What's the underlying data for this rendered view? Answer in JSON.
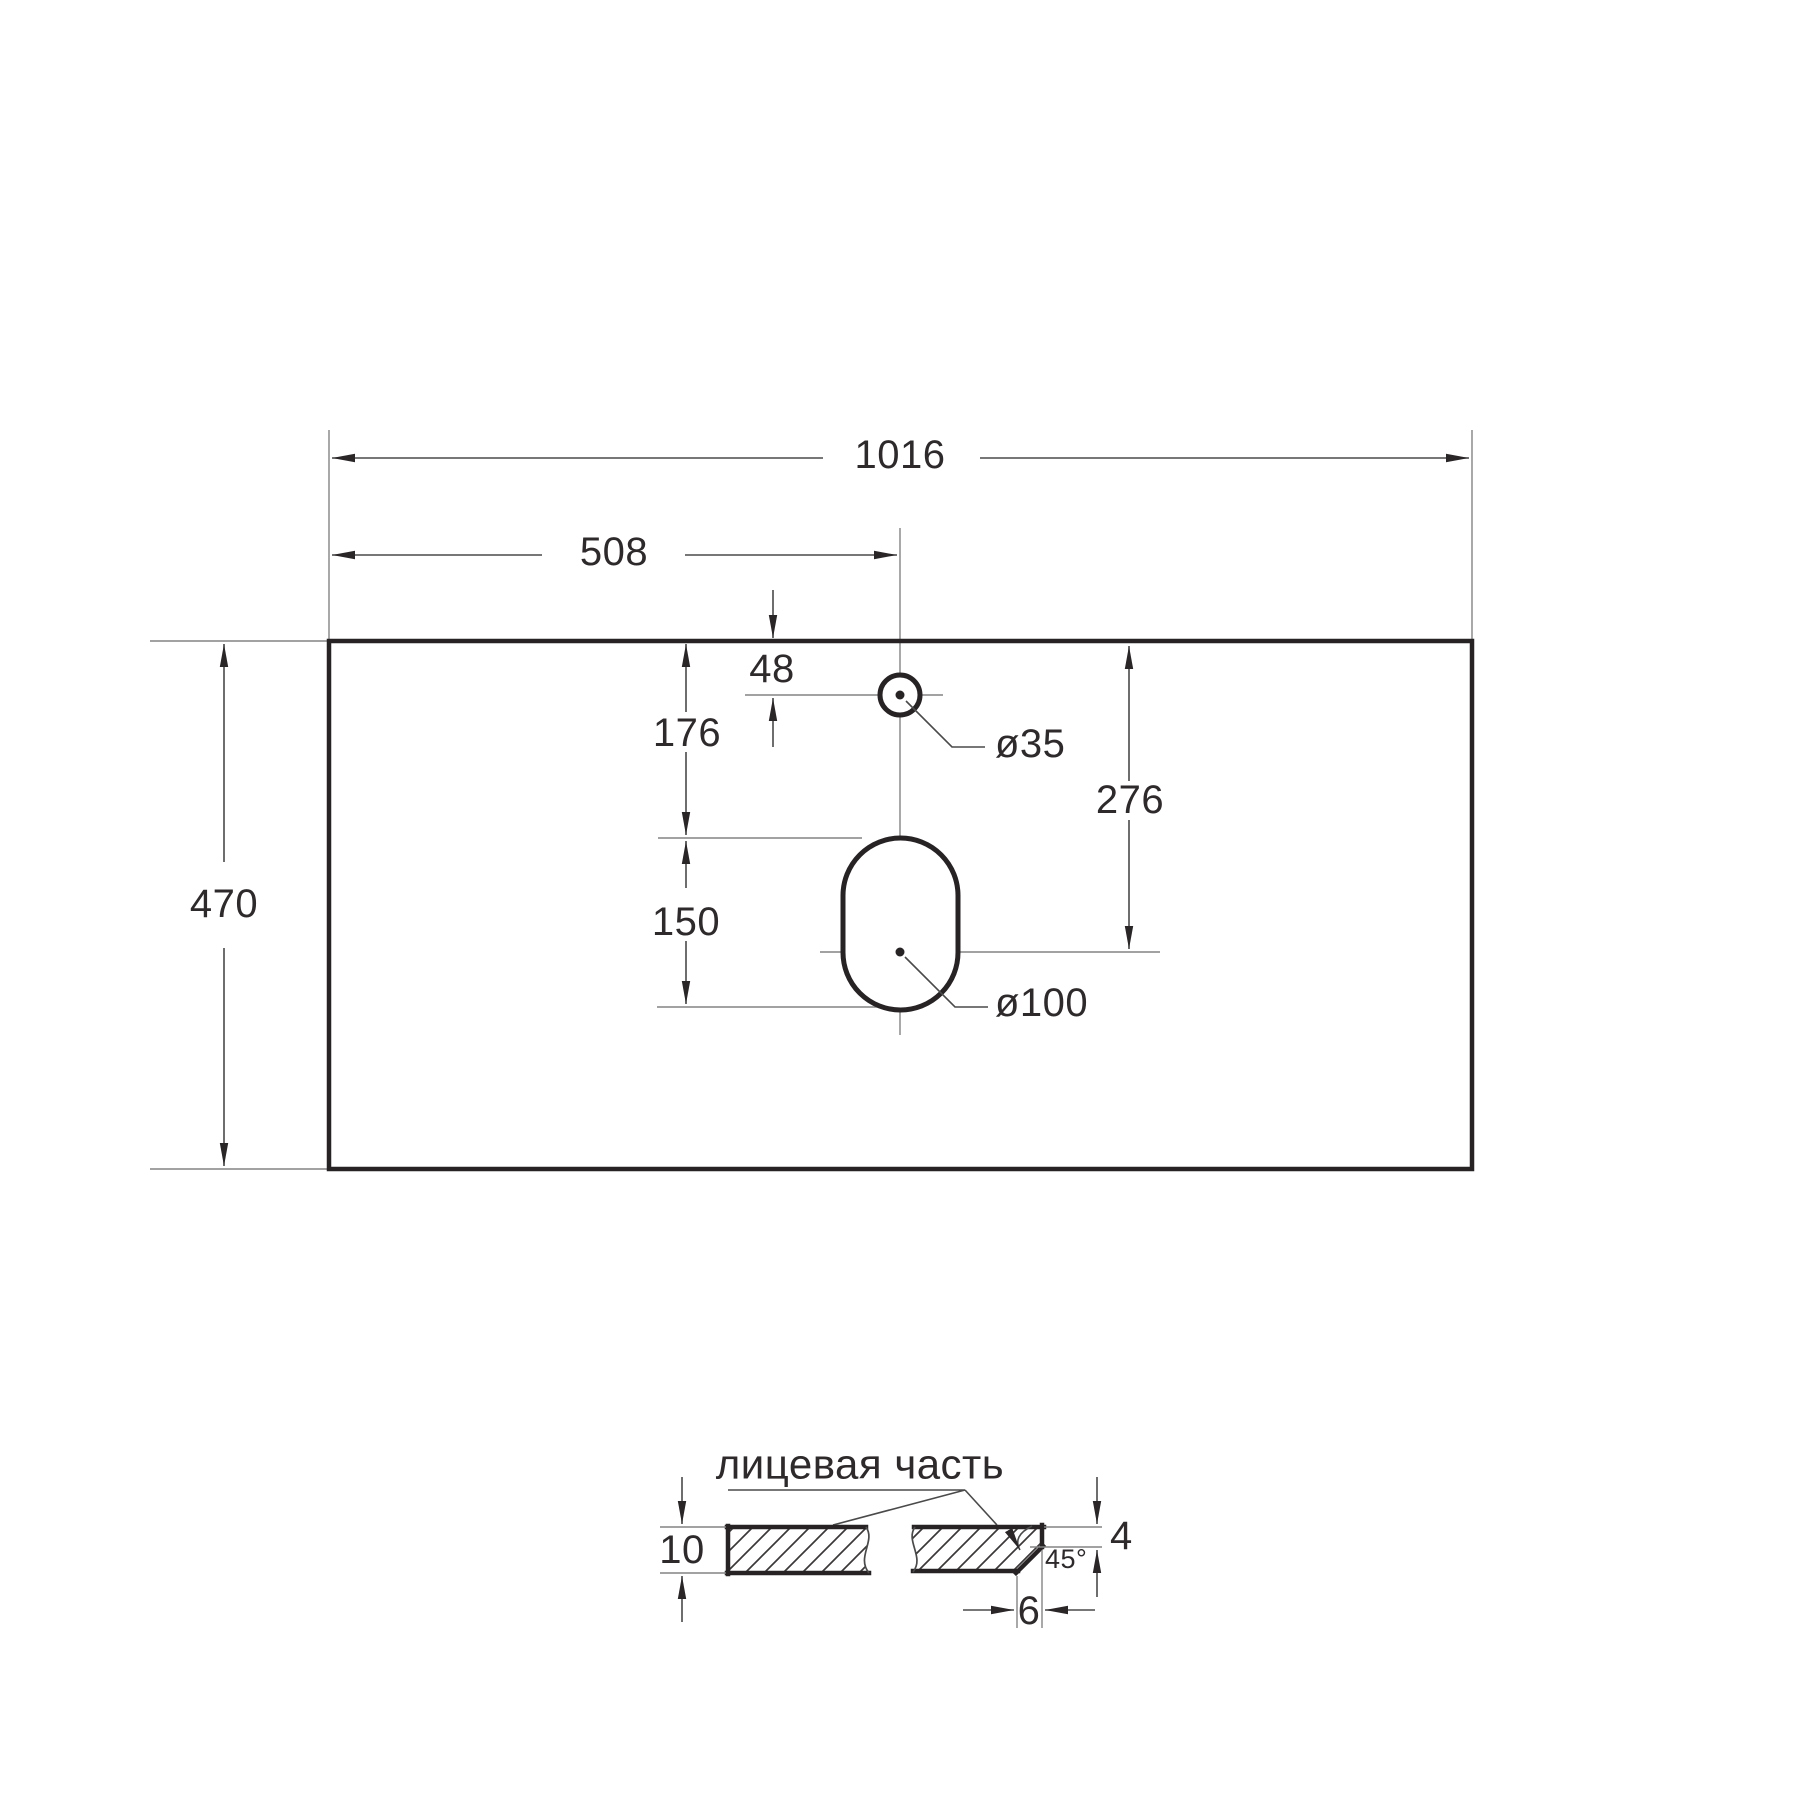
{
  "plan": {
    "overall_width": "1016",
    "center_offset": "508",
    "depth": "470",
    "faucet_from_edge": "48",
    "faucet_to_slot": "176",
    "slot_length": "150",
    "drain_from_edge": "276",
    "faucet_hole_dia": "ø35",
    "drain_hole_dia": "ø100"
  },
  "section": {
    "face_label": "лицевая часть",
    "thickness": "10",
    "chamfer_height": "4",
    "chamfer_angle": "45°",
    "chamfer_width": "6"
  },
  "colors": {
    "outline": "#272324",
    "dimension": "#4a4a4a",
    "extension": "#848484",
    "text": "#2e2a2b",
    "background": "#ffffff"
  }
}
